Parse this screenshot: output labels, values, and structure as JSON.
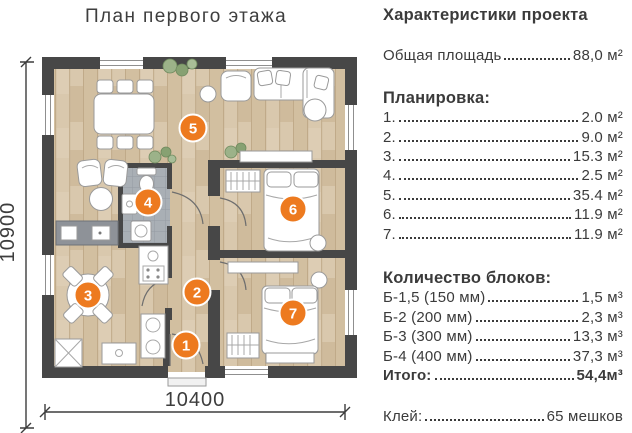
{
  "theme": {
    "accent": "#ed7a1f",
    "wall": "#474747",
    "floor": "#d8c7ab",
    "text": "#3b3b3b"
  },
  "page": {
    "title": "План первого этажа"
  },
  "plan": {
    "dimensions": {
      "width_mm": "10400",
      "height_mm": "10900"
    },
    "room_labels": {
      "r1": "1",
      "r2": "2",
      "r3": "3",
      "r4": "4",
      "r5": "5",
      "r6": "6",
      "r7": "7"
    }
  },
  "specs": {
    "header": "Характеристики проекта",
    "total_area": {
      "label": "Общая площадь",
      "value": "88,0 м²"
    },
    "layout_section": {
      "header": "Планировка:",
      "items": [
        {
          "label": "1.",
          "value": "2.0 м²"
        },
        {
          "label": "2.",
          "value": "9.0 м²"
        },
        {
          "label": "3.",
          "value": "15.3 м²"
        },
        {
          "label": "4.",
          "value": "2.5 м²"
        },
        {
          "label": "5.",
          "value": "35.4 м²"
        },
        {
          "label": "6.",
          "value": "11.9 м²"
        },
        {
          "label": "7.",
          "value": "11.9 м²"
        }
      ]
    },
    "blocks_section": {
      "header": "Количество блоков:",
      "items": [
        {
          "label": "Б-1,5 (150 мм)",
          "value": "1,5 м³"
        },
        {
          "label": "Б-2 (200 мм)",
          "value": "2,3 м³"
        },
        {
          "label": "Б-3 (300 мм)",
          "value": "13,3 м³"
        },
        {
          "label": "Б-4 (400 мм)",
          "value": "37,3 м³"
        }
      ],
      "total": {
        "label": "Итого:",
        "value": "54,4м³"
      }
    },
    "glue": {
      "label": "Клей:",
      "value": "65 мешков"
    }
  }
}
